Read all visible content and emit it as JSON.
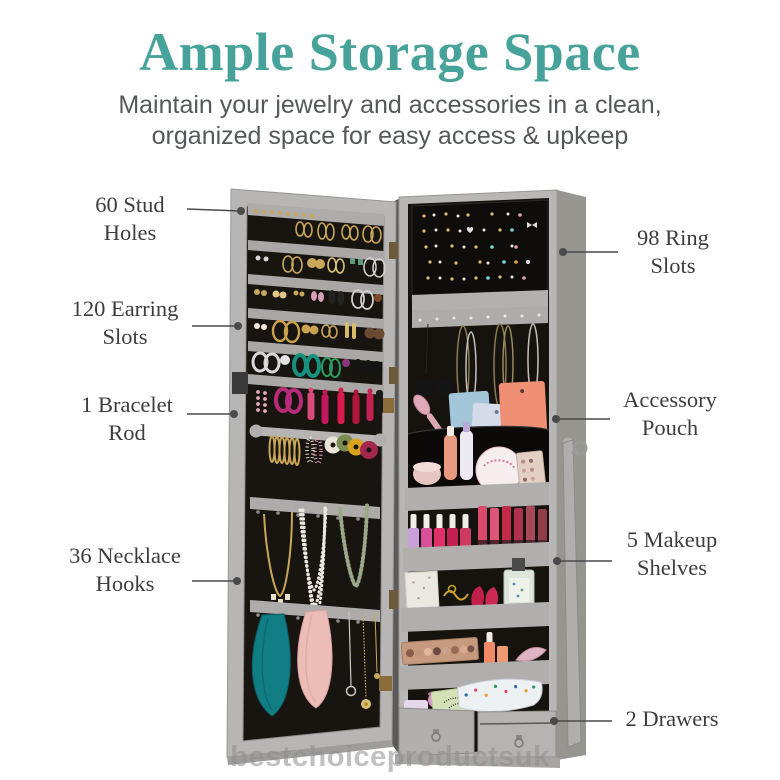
{
  "header": {
    "title": "Ample Storage Space",
    "subtitle_line1": "Maintain your jewelry and accessories in a clean,",
    "subtitle_line2": "organized space for easy access & upkeep"
  },
  "callouts": {
    "stud_holes": {
      "label": "60 Stud\nHoles"
    },
    "earring_slots": {
      "label": "120 Earring\nSlots"
    },
    "bracelet_rod": {
      "label": "1 Bracelet\nRod"
    },
    "necklace_hooks": {
      "label": "36 Necklace\nHooks"
    },
    "ring_slots": {
      "label": "98 Ring\nSlots"
    },
    "accessory_pouch": {
      "label": "Accessory\nPouch"
    },
    "makeup_shelves": {
      "label": "5 Makeup\nShelves"
    },
    "drawers": {
      "label": "2 Drawers"
    }
  },
  "watermark": {
    "text": "bestchoiceproductsuk"
  },
  "colors": {
    "title_teal": "#47a29a",
    "subtitle_gray": "#55585a",
    "label_dark": "#3d3d3d",
    "cabinet_gray": "#b9b7b5",
    "interior_black": "#17130e",
    "leader_line": "#4a4a4a",
    "watermark_gray": "#8e8e8e"
  }
}
